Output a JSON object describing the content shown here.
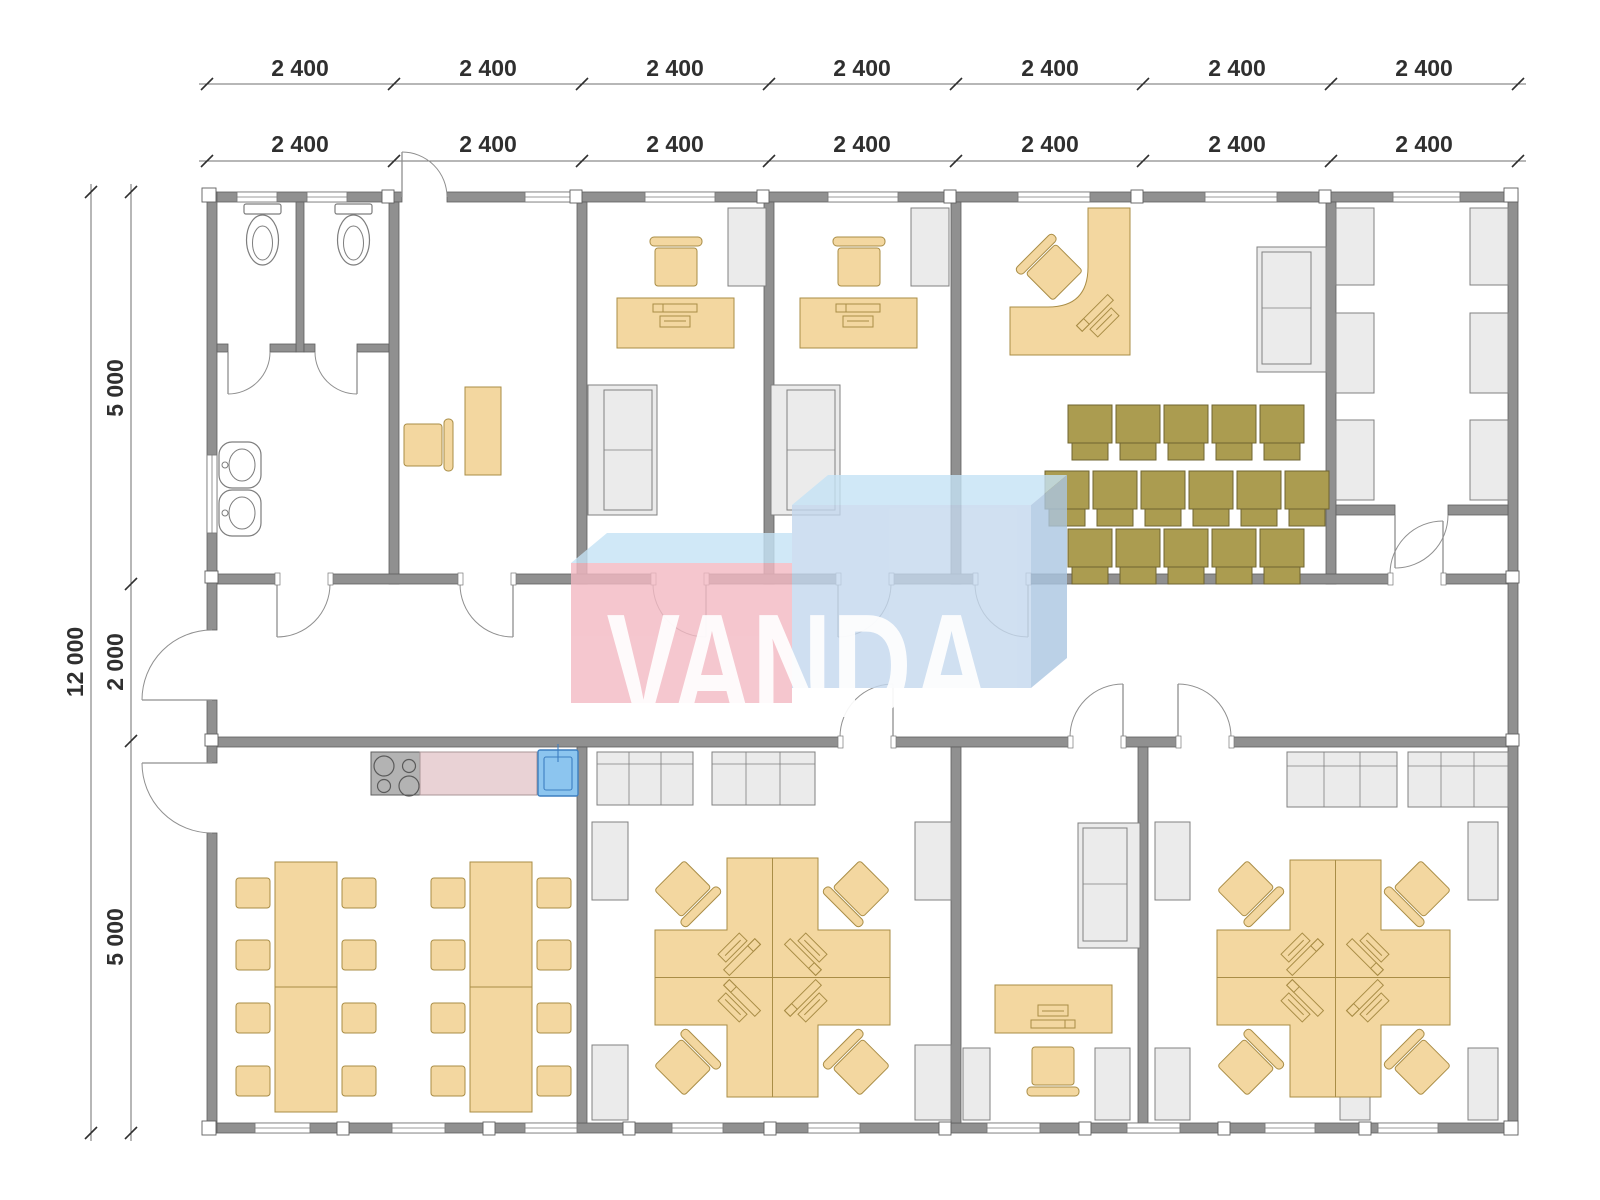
{
  "watermark": {
    "text": "VANDA"
  },
  "dimensions": {
    "top_row1": [
      "2 400",
      "2 400",
      "2 400",
      "2 400",
      "2 400",
      "2 400",
      "2 400"
    ],
    "top_row2": [
      "2 400",
      "2 400",
      "2 400",
      "2 400",
      "2 400",
      "2 400",
      "2 400"
    ],
    "left_total": "12 000",
    "left_segments": [
      "5 000",
      "2 000",
      "5 000"
    ]
  },
  "colors": {
    "wall": "#909090",
    "wall_stroke": "#5f5f5f",
    "line": "#7a7a7a",
    "furniture_tan": "#f3d7a0",
    "tan_stroke": "#a98d46",
    "chair_olive": "#ab9c50",
    "olive_stroke": "#6f6430",
    "cabinet_fill": "#ebebeb",
    "cabinet_stroke": "#808080",
    "counter_pink": "#e9d2d5",
    "sink_blue": "#8cc5ef",
    "sink_stroke": "#3d7fc1",
    "stove_gray": "#b3b3b3",
    "fixture_stroke": "#7d7d7d",
    "dim_text": "#2f2f2f",
    "dim_line": "#6f6f6f",
    "wm_pink": "#f3b9c3",
    "wm_top": "#c5e3f6",
    "wm_front_blue": "#c4d8ee",
    "wm_side_blue": "#abc6e2",
    "wm_letters": "#ffffff"
  },
  "legend_icons": [
    "toilet-icon",
    "washbasin-icon",
    "office-desk-icon",
    "office-chair-icon",
    "sofa-icon",
    "cabinet-icon",
    "stove-icon",
    "kitchen-sink-icon",
    "kitchen-counter-icon",
    "dining-table-icon",
    "dining-chair-icon",
    "workstation-cluster-icon",
    "training-chair-icon",
    "door-icon",
    "window-icon"
  ]
}
